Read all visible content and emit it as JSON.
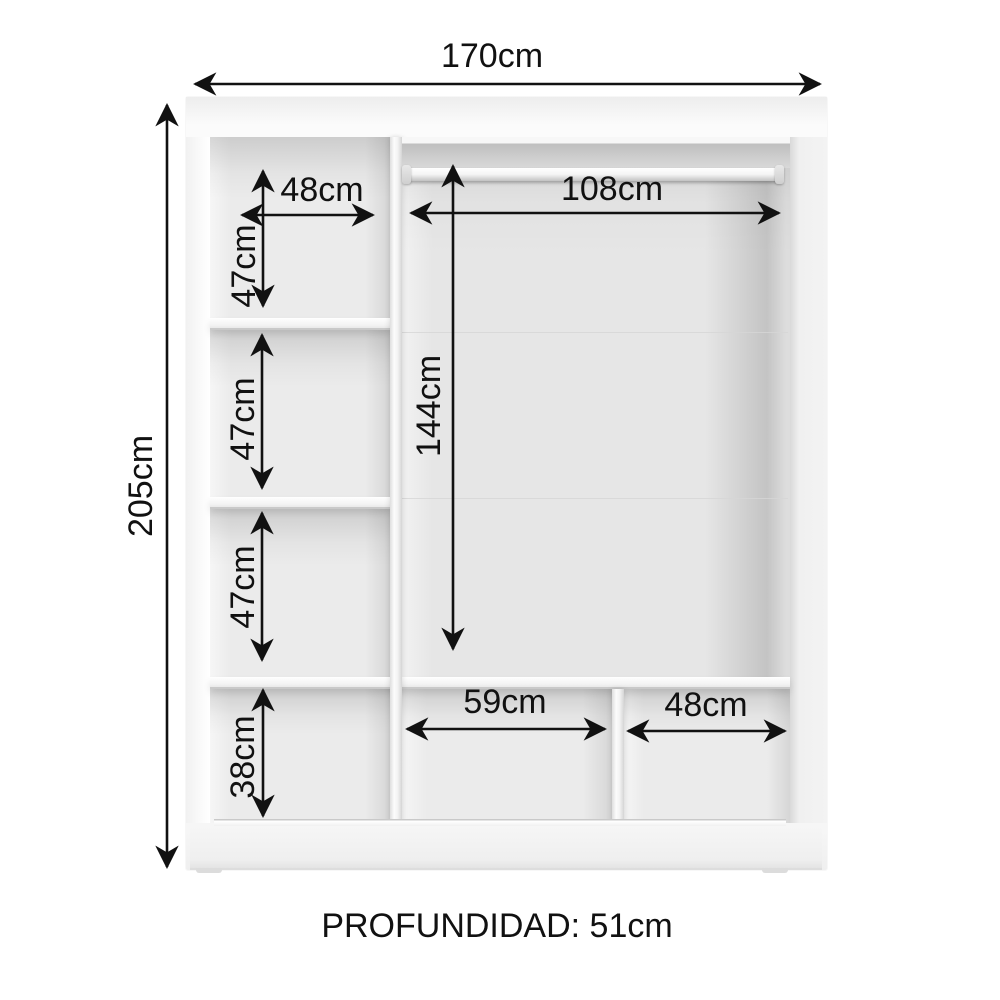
{
  "labels": {
    "overall_width": "170cm",
    "overall_height": "205cm",
    "top_shelf_width": "48cm",
    "upper_shelf_height": "47cm",
    "middle_shelf_height": "47cm",
    "lower_shelf_height": "47cm",
    "hanging_rod_width": "108cm",
    "hanging_space_height": "144cm",
    "bottom_shelf_height": "38cm",
    "bottom_middle_width": "59cm",
    "bottom_right_width": "48cm",
    "depth_note": "PROFUNDIDAD: 51cm"
  },
  "colors": {
    "dimension_lines": "#111111",
    "cabinet_body": "#f6f6f6",
    "interior_back": "#ebebeb",
    "background": "#ffffff"
  }
}
